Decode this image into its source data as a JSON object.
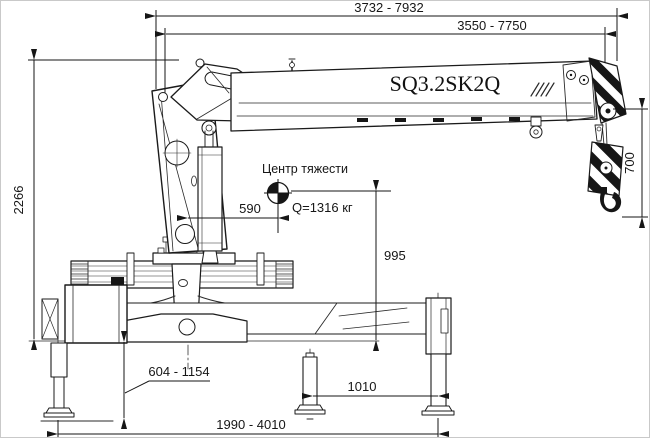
{
  "model_label": "SQ3.2SK2Q",
  "center_of_gravity": {
    "label": "Центр тяжести",
    "load": "Q=1316 кг"
  },
  "dimensions": {
    "overall_length": "3732 - 7932",
    "boom_length": "3550 - 7750",
    "overall_height": "2266",
    "hook_drop": "700",
    "cog_offset": "590",
    "cog_height": "995",
    "outrigger_leg_extension": "604 - 1154",
    "outrigger_rear_spacing": "1010",
    "outrigger_span": "1990 - 4010"
  }
}
